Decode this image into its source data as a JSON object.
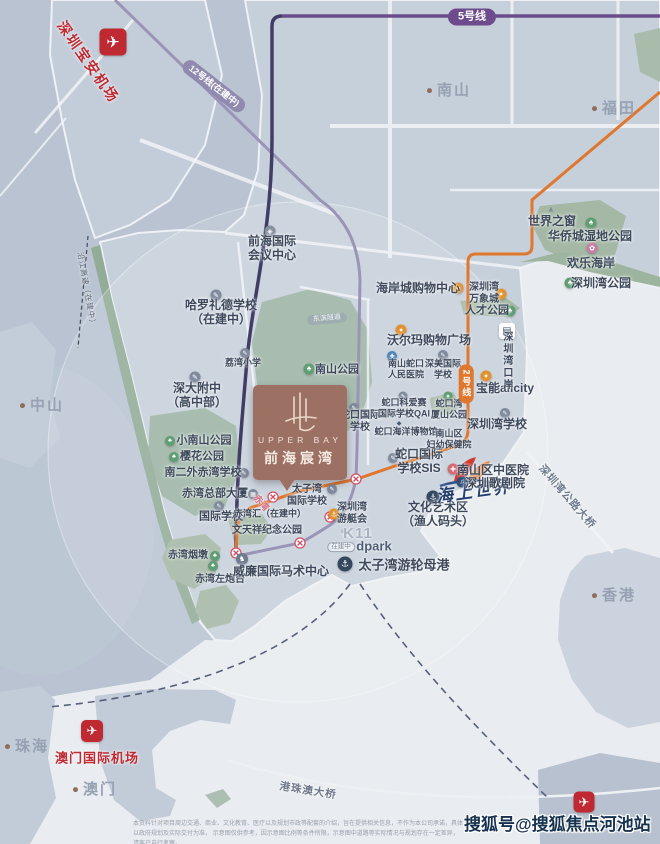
{
  "meta": {
    "watermark": "搜狐号@搜狐焦点河池站",
    "disclaimer_l1": "本资料针对项目周边交通、商业、文化教育、医疗以及规划市政等配套的介绍，旨在提供相关信息，不作为本公司承诺，具体以政府规划及实际交付为准，",
    "disclaimer_l2": "示意图仅供参考，因示意图比例等条件所限，示意图中道路等实际情况与规划存在一定差异，请客户自行考察。"
  },
  "project": {
    "logo_en": "UPPER BAY",
    "logo_cn": "前海宸湾"
  },
  "colors": {
    "brand_brown": "#9c7164",
    "metro_line5": "#6b4b8c",
    "metro_line12": "#9a94b6",
    "metro_line2": "#e0772e",
    "airport_red": "#bf2a32",
    "park_green": "#9db4a6",
    "bay_water": "#e9ecf0"
  },
  "labels": [
    {
      "id": "shenzhen-baoan-airport-label",
      "text": "深圳宝安机场",
      "x": 88,
      "y": 62,
      "cls": "red-airport",
      "rot": 55
    },
    {
      "id": "line12-pill",
      "text": "12号线(在建中)",
      "x": 214,
      "y": 86,
      "cls": "pill pill12",
      "rot": 38
    },
    {
      "id": "line5-pill",
      "text": "5号线",
      "x": 472,
      "y": 17,
      "cls": "pill pill5"
    },
    {
      "id": "city-nanshan",
      "text": "南山",
      "x": 449,
      "y": 91,
      "cls": "city"
    },
    {
      "id": "city-futian",
      "text": "福田",
      "x": 614,
      "y": 109,
      "cls": "city"
    },
    {
      "id": "poi-window-of-the-world",
      "text": "世界之窗",
      "x": 552,
      "y": 221,
      "cls": "sz12"
    },
    {
      "id": "poi-oct-wetland-park",
      "text": "华侨城湿地公园",
      "x": 590,
      "y": 236,
      "cls": "sz12"
    },
    {
      "id": "poi-happy-coast",
      "text": "欢乐海岸",
      "x": 591,
      "y": 263,
      "cls": "sz12"
    },
    {
      "id": "poi-shenzhen-bay-park",
      "text": "深圳湾公园",
      "x": 601,
      "y": 283,
      "cls": "sz12"
    },
    {
      "id": "poi-shenzhen-bay-mixc",
      "lines": [
        "深圳湾",
        "万象城"
      ],
      "x": 484,
      "y": 294,
      "cls": "sz10"
    },
    {
      "id": "poi-talent-park",
      "text": "人才公园",
      "x": 487,
      "y": 311,
      "cls": "sz11"
    },
    {
      "id": "poi-coastal-city-mall",
      "text": "海岸城购物中心",
      "x": 418,
      "y": 288,
      "cls": "sz12"
    },
    {
      "id": "poi-qianhai-conference-center",
      "lines": [
        "前海国际",
        "会议中心"
      ],
      "x": 272,
      "y": 248,
      "cls": "sz12"
    },
    {
      "id": "poi-harrow-school",
      "lines": [
        "哈罗礼德学校",
        "（在建中）"
      ],
      "x": 221,
      "y": 312,
      "cls": "sz12"
    },
    {
      "id": "poi-liwan-primary",
      "text": "荔湾小学",
      "x": 243,
      "y": 363,
      "cls": "sz9"
    },
    {
      "id": "poi-shenda-fuzhong",
      "lines": [
        "深大附中",
        "（高中部）"
      ],
      "x": 197,
      "y": 395,
      "cls": "sz12"
    },
    {
      "id": "poi-nanshan-park",
      "text": "南山公园",
      "x": 337,
      "y": 370,
      "cls": "sz11"
    },
    {
      "id": "city-zhongshan",
      "text": "中山",
      "x": 42,
      "y": 406,
      "cls": "city"
    },
    {
      "id": "poi-xiaonanshan-park",
      "text": "小南山公园",
      "x": 204,
      "y": 441,
      "cls": "sz11"
    },
    {
      "id": "poi-sakura-park",
      "text": "樱花公园",
      "x": 202,
      "y": 457,
      "cls": "sz11"
    },
    {
      "id": "poi-nanerwai-chiwan-school",
      "text": "南二外赤湾学校",
      "x": 203,
      "y": 473,
      "cls": "sz11"
    },
    {
      "id": "poi-chiwan-headquarters",
      "text": "赤湾总部大厦",
      "x": 215,
      "y": 494,
      "cls": "sz11"
    },
    {
      "id": "poi-international-school",
      "text": "国际学校",
      "x": 221,
      "y": 517,
      "cls": "sz11"
    },
    {
      "id": "poi-chiwan-yandun",
      "text": "赤湾烟墩",
      "x": 188,
      "y": 556,
      "cls": "sz10"
    },
    {
      "id": "poi-chiwan-fort",
      "text": "赤湾左炮台",
      "x": 220,
      "y": 580,
      "cls": "sz10"
    },
    {
      "id": "poi-wentianxiang-park",
      "text": "文天祥纪念公园",
      "x": 267,
      "y": 531,
      "cls": "sz10"
    },
    {
      "id": "poi-chiwanhui",
      "text": "赤湾汇（在建中）",
      "x": 270,
      "y": 514,
      "cls": "sz9"
    },
    {
      "id": "poi-equestrian-center",
      "text": "威廉国际马术中心",
      "x": 281,
      "y": 571,
      "cls": "sz12"
    },
    {
      "id": "poi-taiziwan-intl-school",
      "lines": [
        "太子湾",
        "国际学校"
      ],
      "x": 307,
      "y": 496,
      "cls": "sz10"
    },
    {
      "id": "poi-yacht-club",
      "lines": [
        "深圳湾",
        "游艇会"
      ],
      "x": 352,
      "y": 514,
      "cls": "sz10"
    },
    {
      "id": "poi-k11",
      "text": "K11",
      "x": 358,
      "y": 534,
      "cls": "k11"
    },
    {
      "id": "poi-k11-status",
      "text": "在建中",
      "x": 341,
      "y": 547,
      "cls": "badge-outline"
    },
    {
      "id": "poi-dpark",
      "text": "dpark",
      "x": 374,
      "y": 546,
      "cls": "dpark"
    },
    {
      "id": "poi-culture-art-zone",
      "lines": [
        "文化艺术区",
        "（渔人码头）"
      ],
      "x": 438,
      "y": 514,
      "cls": "sz12"
    },
    {
      "id": "poi-cruise-home-port",
      "text": "太子湾游轮母港",
      "x": 404,
      "y": 565,
      "cls": "sz13"
    },
    {
      "id": "seaworld-script",
      "text": "海上世界",
      "x": 474,
      "y": 492,
      "cls": "script",
      "rot": -8
    },
    {
      "id": "poi-sis-school",
      "lines": [
        "蛇口国际",
        "学校SIS"
      ],
      "x": 419,
      "y": 461,
      "cls": "sz12"
    },
    {
      "id": "poi-shekou-intl-school",
      "lines": [
        "蛇口国际",
        "学校"
      ],
      "x": 360,
      "y": 422,
      "cls": "sz10"
    },
    {
      "id": "poi-qai-school",
      "lines": [
        "蛇口科爱赛",
        "国际学校QAI"
      ],
      "x": 404,
      "y": 408,
      "cls": "sz9"
    },
    {
      "id": "poi-wanxiashan-park",
      "lines": [
        "蛇口湾",
        "厦山公园"
      ],
      "x": 449,
      "y": 409,
      "cls": "sz9"
    },
    {
      "id": "poi-ocean-museum",
      "text": "蛇口海洋博物馆",
      "x": 406,
      "y": 432,
      "cls": "sz9"
    },
    {
      "id": "poi-fuyou-hospital",
      "lines": [
        "南山区",
        "妇幼保健院"
      ],
      "x": 449,
      "y": 439,
      "cls": "sz9"
    },
    {
      "id": "poi-shenzhen-bay-school",
      "text": "深圳湾学校",
      "x": 497,
      "y": 424,
      "cls": "sz12"
    },
    {
      "id": "poi-nanshan-tcm-hospital",
      "text": "南山区中医院",
      "x": 493,
      "y": 470,
      "cls": "sz12"
    },
    {
      "id": "poi-shenzhen-opera",
      "text": "深圳歌剧院",
      "x": 495,
      "y": 483,
      "cls": "sz12"
    },
    {
      "id": "poi-renmin-hospital",
      "lines": [
        "南山蛇口",
        "人民医院"
      ],
      "x": 406,
      "y": 369,
      "cls": "sz9"
    },
    {
      "id": "poi-shenmei-school",
      "lines": [
        "深美国际",
        "学校"
      ],
      "x": 443,
      "y": 369,
      "cls": "sz9"
    },
    {
      "id": "poi-walmart",
      "text": "沃尔玛购物广场",
      "x": 429,
      "y": 340,
      "cls": "sz12"
    },
    {
      "id": "poi-baoneng-allcity",
      "text": "宝能allcity",
      "x": 505,
      "y": 388,
      "cls": "sz12"
    },
    {
      "id": "poi-shenzhen-bay-port",
      "text": "深圳湾口岸",
      "x": 506,
      "y": 361,
      "cls": "v-text"
    },
    {
      "id": "line2-pill",
      "text": "2号线",
      "x": 466,
      "y": 384,
      "cls": "pill pill2v"
    },
    {
      "id": "shenzhen-bay-bridge-label",
      "text": "深圳湾公路大桥",
      "x": 567,
      "y": 497,
      "cls": "bridge-label",
      "rot": 49
    },
    {
      "id": "city-hongkong",
      "text": "香港",
      "x": 614,
      "y": 596,
      "cls": "city"
    },
    {
      "id": "city-zhuhai",
      "text": "珠海",
      "x": 27,
      "y": 747,
      "cls": "city"
    },
    {
      "id": "macau-airport-label",
      "text": "澳门国际机场",
      "x": 97,
      "y": 758,
      "cls": "red-airport-h"
    },
    {
      "id": "city-macau",
      "text": "澳门",
      "x": 95,
      "y": 790,
      "cls": "city"
    },
    {
      "id": "hzm-bridge-label",
      "text": "港珠澳大桥",
      "x": 308,
      "y": 791,
      "cls": "bridge-label",
      "rot": 9
    },
    {
      "id": "chiwan-station-label",
      "text": "赤湾",
      "x": 261,
      "y": 503,
      "cls": "station-name",
      "rot": 48
    },
    {
      "id": "yanjiang-expressway-label",
      "text": "沿江高速（在建中）",
      "x": 86,
      "y": 290,
      "cls": "road-vlabel",
      "rot": 80
    },
    {
      "id": "dongbin-road-badge",
      "text": "东滨隧道",
      "x": 327,
      "y": 319,
      "cls": "road-badge",
      "rot": -5
    }
  ],
  "icons": [
    {
      "id": "shenzhen-airport-icon",
      "glyph": "✈",
      "cls": "sq",
      "x": 113,
      "y": 42,
      "size": 27
    },
    {
      "id": "macau-airport-icon",
      "glyph": "✈",
      "cls": "sq",
      "x": 92,
      "y": 731,
      "size": 22
    },
    {
      "id": "hongkong-airport-icon",
      "glyph": "✈",
      "cls": "sq",
      "x": 584,
      "y": 802,
      "size": 21
    },
    {
      "id": "window-of-the-world-icon",
      "glyph": "▲",
      "cls": "plain",
      "x": 551,
      "y": 209,
      "size": 13
    },
    {
      "id": "oct-wetland-park-icon",
      "glyph": "♣",
      "cls": "c",
      "bg": "#5f9e72",
      "x": 591,
      "y": 223,
      "size": 11
    },
    {
      "id": "happy-coast-icon",
      "glyph": "✿",
      "cls": "c",
      "bg": "#c77ea6",
      "x": 592,
      "y": 248,
      "size": 11
    },
    {
      "id": "shenzhen-bay-park-icon",
      "glyph": "♣",
      "cls": "c",
      "bg": "#5f9e72",
      "x": 570,
      "y": 283,
      "size": 11
    },
    {
      "id": "talent-park-icon",
      "glyph": "♣",
      "cls": "c",
      "bg": "#5f9e72",
      "x": 510,
      "y": 311,
      "size": 11
    },
    {
      "id": "mixc-shopping-icon",
      "glyph": "✦",
      "cls": "c",
      "bg": "#e2912f",
      "x": 501,
      "y": 294,
      "size": 11
    },
    {
      "id": "coastal-city-shopping-icon",
      "glyph": "✦",
      "cls": "c",
      "bg": "#e2912f",
      "x": 458,
      "y": 288,
      "size": 11
    },
    {
      "id": "walmart-shopping-icon",
      "glyph": "✦",
      "cls": "c",
      "bg": "#e2912f",
      "x": 401,
      "y": 330,
      "size": 11
    },
    {
      "id": "baoneng-shopping-icon",
      "glyph": "✦",
      "cls": "c",
      "bg": "#e2912f",
      "x": 486,
      "y": 376,
      "size": 11
    },
    {
      "id": "qianhai-center-icon",
      "glyph": "◈",
      "cls": "c",
      "bg": "#86919f",
      "x": 270,
      "y": 231,
      "size": 11
    },
    {
      "id": "harrow-school-icon",
      "glyph": "✎",
      "cls": "c",
      "bg": "#7f8b9d",
      "x": 216,
      "y": 295,
      "size": 11
    },
    {
      "id": "liwan-primary-icon",
      "glyph": "✎",
      "cls": "c",
      "bg": "#7f8b9d",
      "x": 245,
      "y": 353,
      "size": 10
    },
    {
      "id": "shenda-school-icon",
      "glyph": "✎",
      "cls": "c",
      "bg": "#7f8b9d",
      "x": 195,
      "y": 377,
      "size": 11
    },
    {
      "id": "nanshan-park-icon",
      "glyph": "♣",
      "cls": "c",
      "bg": "#5f9e72",
      "x": 309,
      "y": 369,
      "size": 11
    },
    {
      "id": "xiaonanshan-park-icon",
      "glyph": "♣",
      "cls": "c",
      "bg": "#5f9e72",
      "x": 170,
      "y": 441,
      "size": 10
    },
    {
      "id": "sakura-park-icon",
      "glyph": "♣",
      "cls": "c",
      "bg": "#5f9e72",
      "x": 174,
      "y": 457,
      "size": 10
    },
    {
      "id": "nanerwai-school-icon",
      "glyph": "✎",
      "cls": "c",
      "bg": "#7f8b9d",
      "x": 244,
      "y": 473,
      "size": 10
    },
    {
      "id": "chiwan-hq-building-icon",
      "glyph": "▦",
      "cls": "c",
      "bg": "#7f8b9d",
      "x": 253,
      "y": 494,
      "size": 10
    },
    {
      "id": "international-school-icon",
      "glyph": "✎",
      "cls": "c",
      "bg": "#7f8b9d",
      "x": 219,
      "y": 506,
      "size": 10
    },
    {
      "id": "chiwan-yandun-icon",
      "glyph": "♣",
      "cls": "c",
      "bg": "#5f9e72",
      "x": 215,
      "y": 556,
      "size": 10
    },
    {
      "id": "chiwan-fort-icon",
      "glyph": "♣",
      "cls": "c",
      "bg": "#5f9e72",
      "x": 213,
      "y": 566,
      "size": 10
    },
    {
      "id": "chiwanhui-building-icon",
      "glyph": "▦",
      "cls": "c",
      "bg": "#86919f",
      "x": 241,
      "y": 514,
      "size": 10
    },
    {
      "id": "equestrian-horse-icon",
      "glyph": "♞",
      "cls": "c",
      "bg": "#6d7b8e",
      "x": 242,
      "y": 559,
      "size": 12
    },
    {
      "id": "taiziwan-school-icon",
      "glyph": "✎",
      "cls": "c",
      "bg": "#7f8b9d",
      "x": 332,
      "y": 489,
      "size": 10
    },
    {
      "id": "yacht-club-anchor-icon",
      "glyph": "⚓",
      "cls": "c",
      "bg": "#e2912f",
      "x": 334,
      "y": 514,
      "size": 11
    },
    {
      "id": "culture-zone-anchor-icon",
      "glyph": "⚓",
      "cls": "c",
      "bg": "#33475e",
      "x": 433,
      "y": 497,
      "size": 13
    },
    {
      "id": "cruise-port-anchor-icon",
      "glyph": "⚓",
      "cls": "c",
      "bg": "#33475e",
      "x": 345,
      "y": 564,
      "size": 15
    },
    {
      "id": "sis-school-icon",
      "glyph": "✎",
      "cls": "c",
      "bg": "#7f8b9d",
      "x": 393,
      "y": 458,
      "size": 10
    },
    {
      "id": "shekou-intl-school-icon",
      "glyph": "✎",
      "cls": "c",
      "bg": "#7f8b9d",
      "x": 354,
      "y": 408,
      "size": 10
    },
    {
      "id": "qai-school-icon",
      "glyph": "✎",
      "cls": "c",
      "bg": "#7f8b9d",
      "x": 403,
      "y": 396,
      "size": 9
    },
    {
      "id": "wanxiashan-park-icon",
      "glyph": "♣",
      "cls": "c",
      "bg": "#5f9e72",
      "x": 448,
      "y": 396,
      "size": 9
    },
    {
      "id": "ocean-museum-whale-icon",
      "glyph": "◆",
      "cls": "plain-dark",
      "x": 399,
      "y": 423,
      "size": 10
    },
    {
      "id": "shenzhen-bay-school-icon",
      "glyph": "✎",
      "cls": "c",
      "bg": "#7f8b9d",
      "x": 505,
      "y": 413,
      "size": 10
    },
    {
      "id": "shenmei-school-icon",
      "glyph": "✎",
      "cls": "c",
      "bg": "#7f8b9d",
      "x": 443,
      "y": 355,
      "size": 10
    },
    {
      "id": "renmin-hospital-icon",
      "glyph": "✚",
      "cls": "c",
      "bg": "#4f86b8",
      "x": 392,
      "y": 356,
      "size": 10
    },
    {
      "id": "tcm-hospital-icon",
      "glyph": "✚",
      "cls": "c",
      "bg": "#d26a75",
      "x": 453,
      "y": 469,
      "size": 11
    },
    {
      "id": "opera-music-icon",
      "glyph": "♫",
      "cls": "c",
      "bg": "#2f4f7a",
      "x": 462,
      "y": 482,
      "size": 11
    },
    {
      "id": "bay-port-building-icon",
      "glyph": "▤",
      "cls": "sqw",
      "x": 507,
      "y": 331,
      "size": 16
    },
    {
      "id": "k11-icon",
      "glyph": "◎",
      "cls": "plain",
      "x": 343,
      "y": 531,
      "size": 9
    }
  ]
}
